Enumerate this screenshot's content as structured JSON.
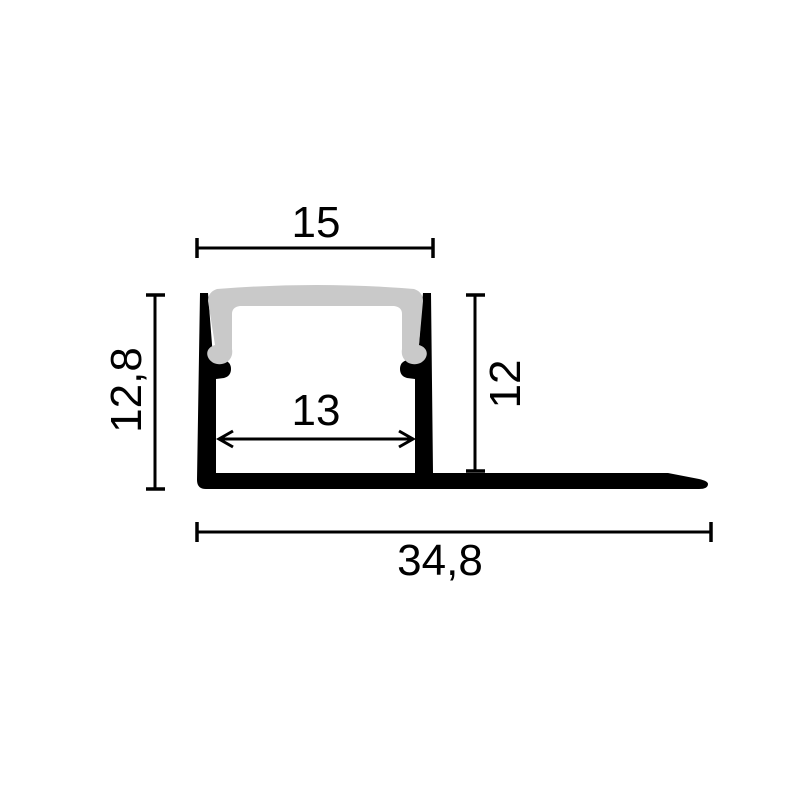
{
  "drawing": {
    "kind": "led-profile-cross-section",
    "dimensions": {
      "top_width": "15",
      "inner_width": "13",
      "height_left": "12,8",
      "height_right": "12",
      "total_width": "34,8"
    },
    "colors": {
      "background": "#ffffff",
      "profile": "#000000",
      "diffuser": "#c9c9c9",
      "line": "#000000",
      "text": "#000000"
    }
  }
}
